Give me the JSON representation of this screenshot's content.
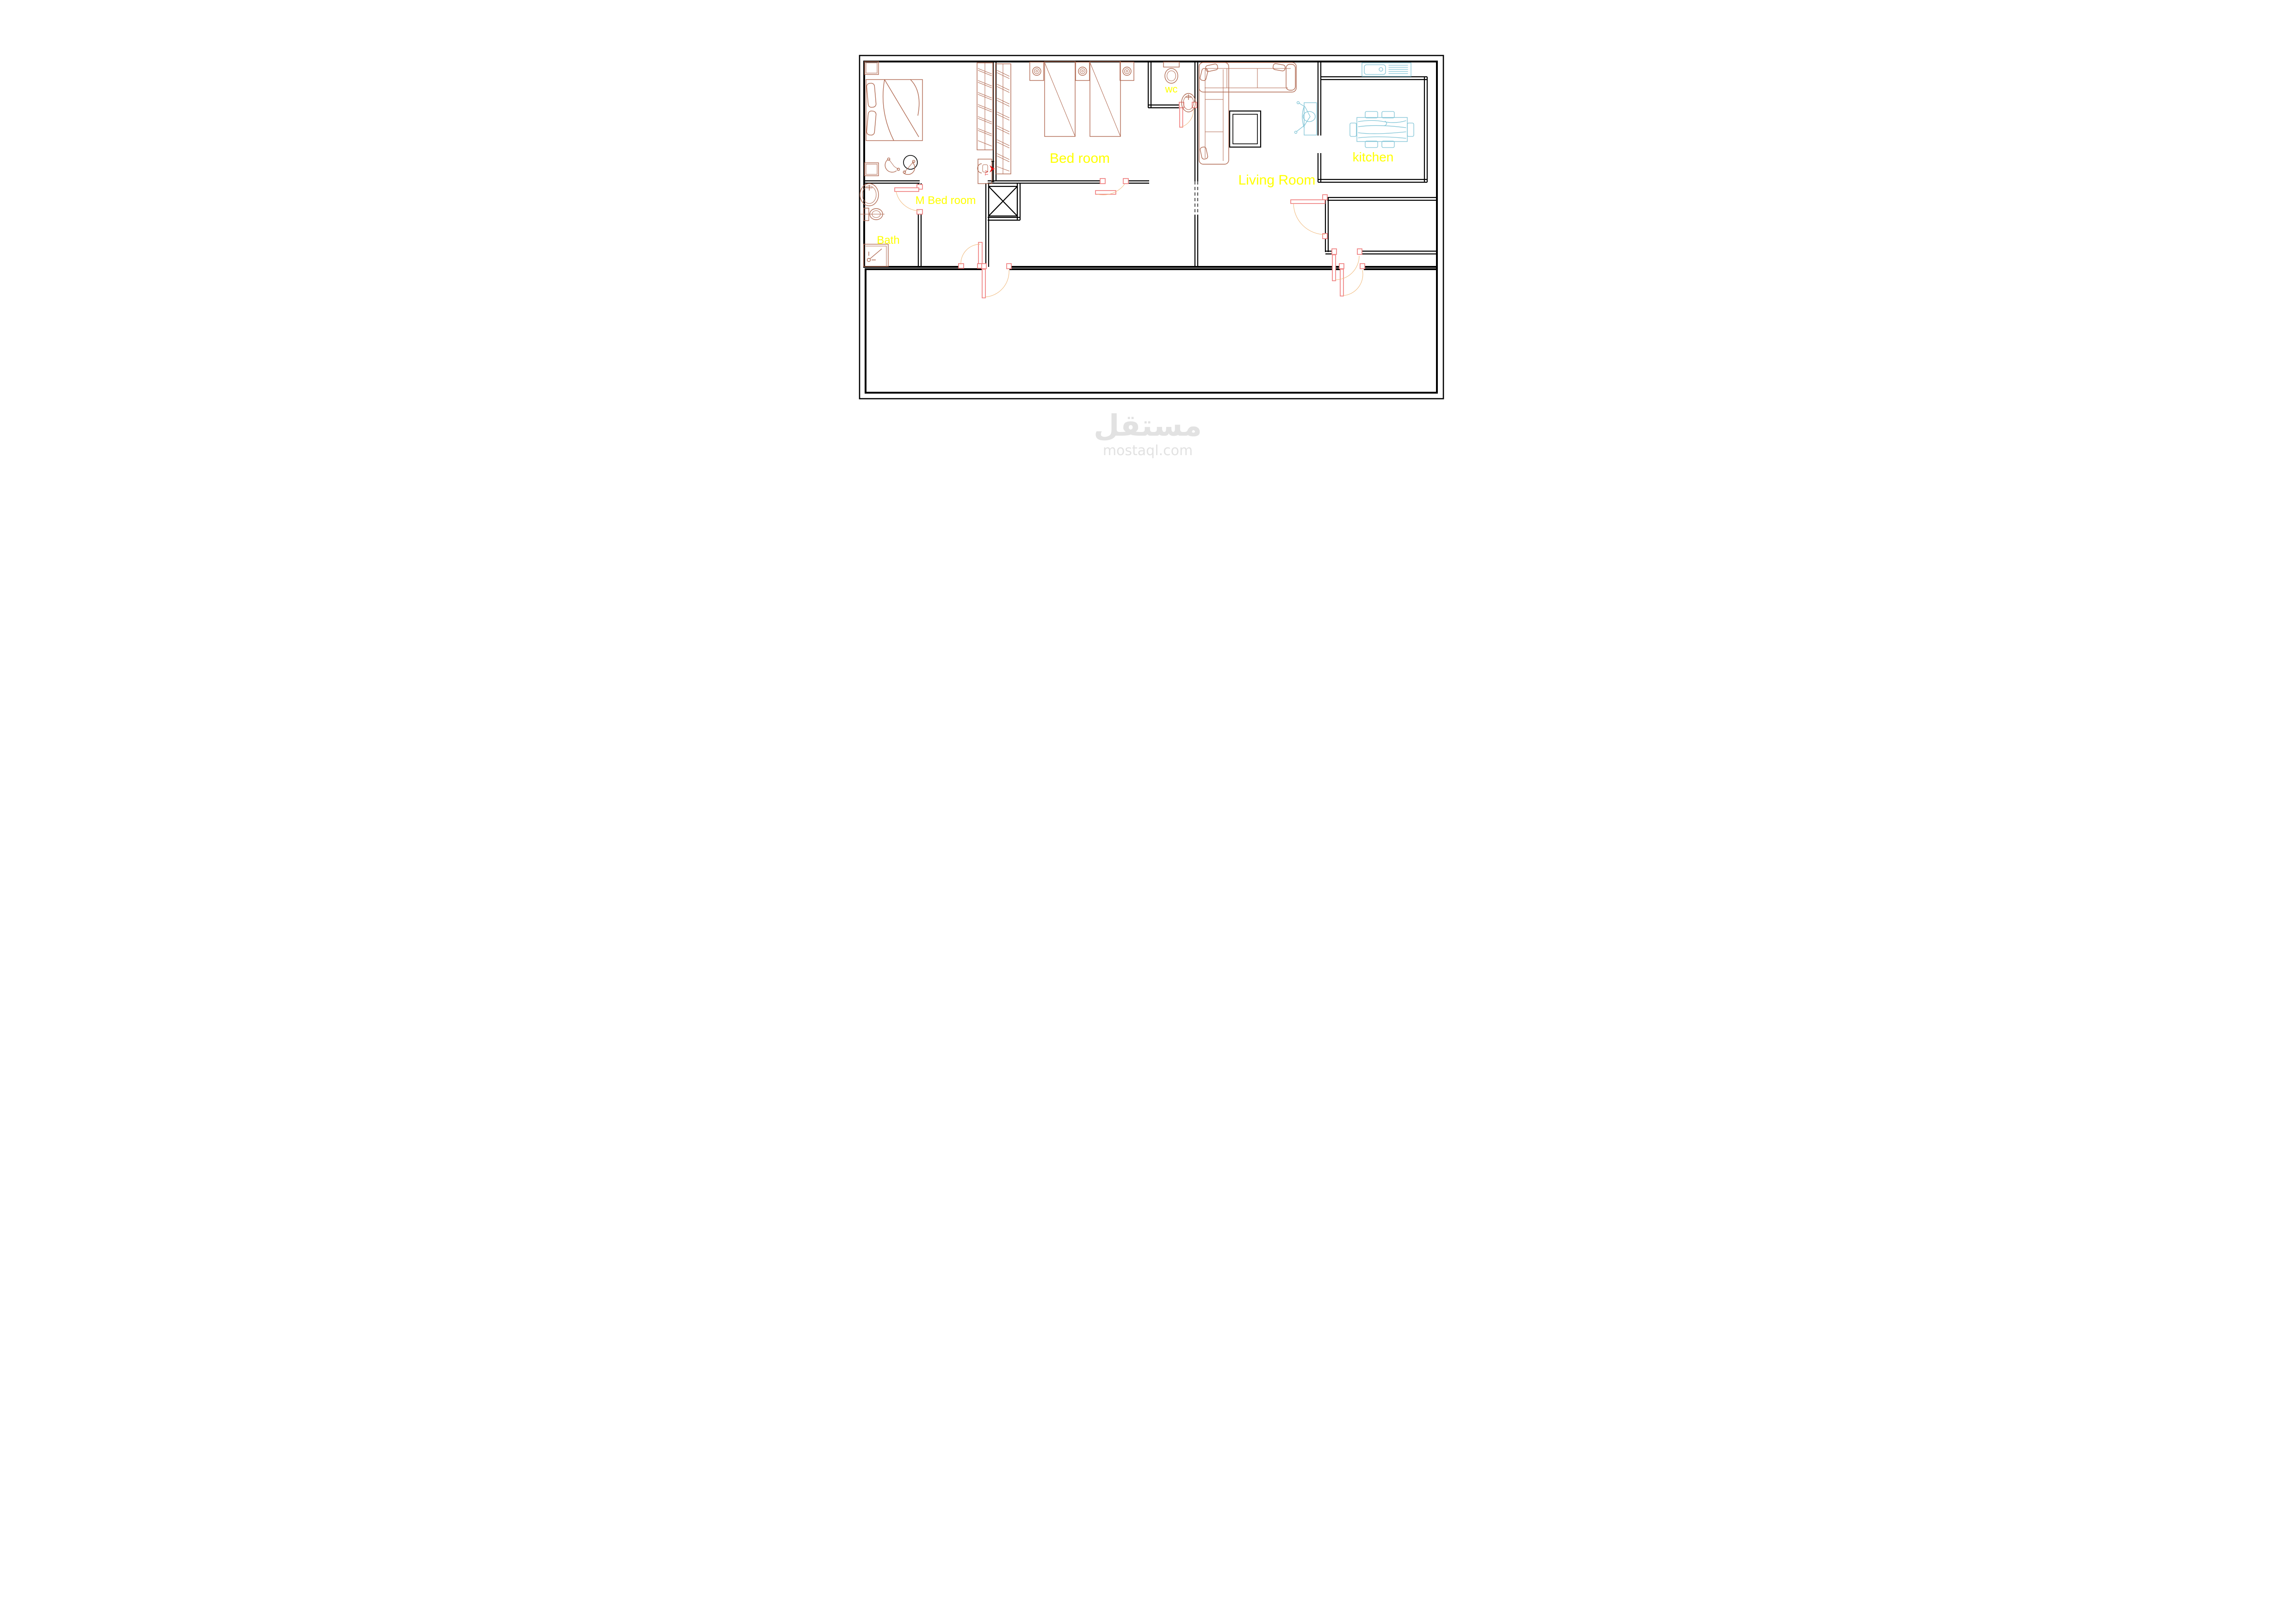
{
  "rooms": {
    "m_bedroom": {
      "label": "M Bed room"
    },
    "bath": {
      "label": "Bath"
    },
    "bedroom": {
      "label": "Bed room"
    },
    "wc": {
      "label": "wc"
    },
    "living_room": {
      "label": "Living Room"
    },
    "kitchen": {
      "label": "kitchen"
    }
  },
  "annotations": {
    "tv_marker": "TV"
  },
  "watermark": {
    "brand": "مستقل",
    "domain": "mostaql.com"
  },
  "colors": {
    "paper": "#ffffff",
    "wall": "#000000",
    "furniture": "#b06a52",
    "door": "#f08080",
    "door-arc": "#f0b87a",
    "fixture": "#7fc4d6",
    "label": "#ffff00",
    "tv": "#dd1111",
    "watermark": "#e2e2e2"
  }
}
